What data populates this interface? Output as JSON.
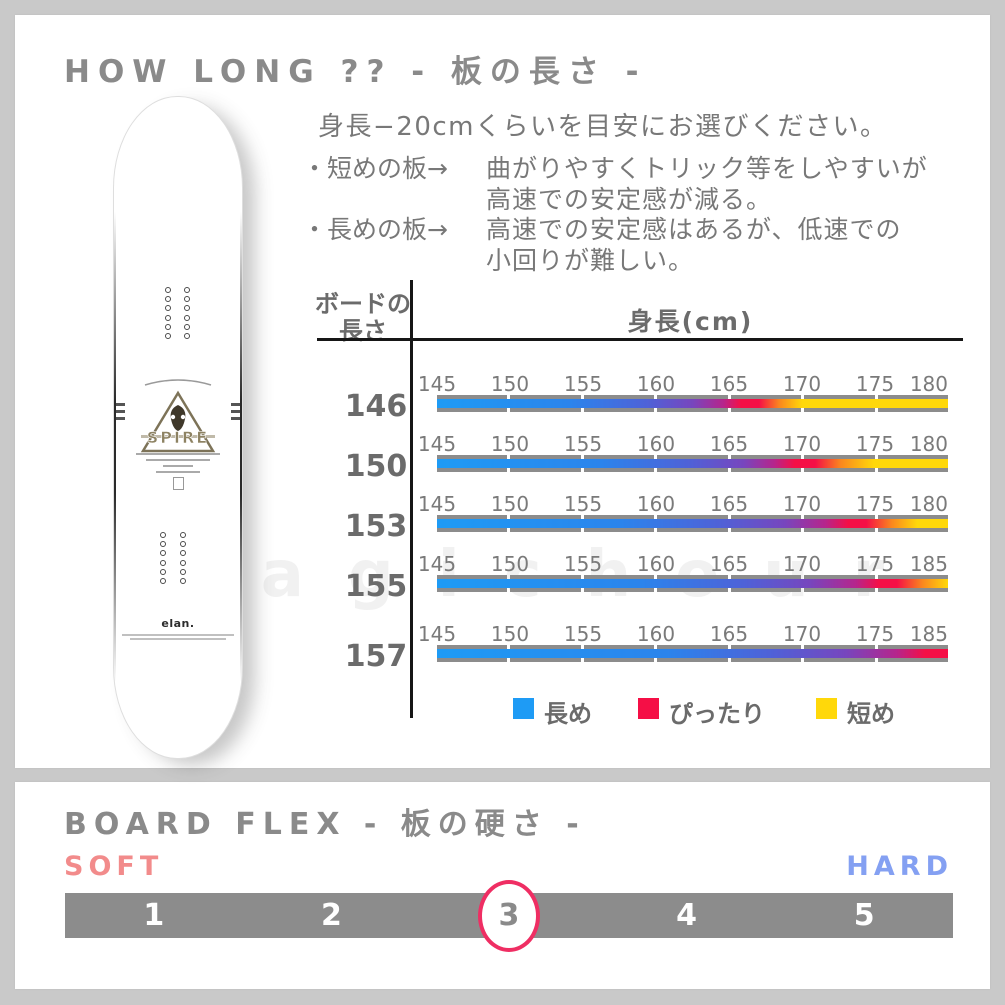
{
  "colors": {
    "page_bg": "#c9c9c9",
    "panel_bg": "#ffffff",
    "title_gray": "#8a8a8a",
    "text_gray": "#787878",
    "table_line": "#161616",
    "bar_gray": "#8c8c8c",
    "soft": "#F28B8B",
    "hard": "#84A0F2",
    "circle": "#EF2E63",
    "legend_blue": "#1E9BF5",
    "legend_red": "#F50F46",
    "legend_yellow": "#FFD80A"
  },
  "watermark": "magichour",
  "how_long": {
    "title": "HOW LONG ?? - 板の長さ -",
    "intro": "身長−20cmくらいを目安にお選びください。",
    "bullet1_label": "・短めの板→",
    "bullet1_line1": "曲がりやすくトリック等をしやすいが",
    "bullet1_line2": "高速での安定感が減る。",
    "bullet2_label": "・長めの板→",
    "bullet2_line1": "高速での安定感はあるが、低速での",
    "bullet2_line2": "小回りが難しい。"
  },
  "board": {
    "brand_logo": "SPIRE",
    "maker_logo": "elan."
  },
  "chart_data": [
    {
      "type": "heatmap",
      "title": "ボードの長さ × 身長(cm) フィットチャート",
      "row_header_line1": "ボードの",
      "row_header_line2": "長さ",
      "col_header": "身長(cm)",
      "legend": [
        {
          "label": "長め",
          "color": "#1E9BF5"
        },
        {
          "label": "ぴったり",
          "color": "#F50F46"
        },
        {
          "label": "短め",
          "color": "#FFD80A"
        }
      ],
      "rows": [
        {
          "length": "146",
          "ticks": [
            "145",
            "150",
            "155",
            "160",
            "165",
            "170",
            "175",
            "180"
          ],
          "best_fit_height": 166,
          "gradient": "linear-gradient(90deg,#1E9BF5 0%,#2B84EC 26%,#4E62D8 41%,#7746BE 50%,#B6258C 56%,#F50F46 59.5%,#F50F46 63%,#FA871E 67%,#FFD80A 71.5%,#FFD80A 100%)"
        },
        {
          "length": "150",
          "ticks": [
            "145",
            "150",
            "155",
            "160",
            "165",
            "170",
            "175",
            "180"
          ],
          "best_fit_height": 170,
          "gradient": "linear-gradient(90deg,#1E9BF5 0%,#2B84EC 32%,#4E62D8 49%,#7746BE 60%,#B6258C 66%,#F50F46 70%,#F50F46 74%,#FA871E 79%,#FFD80A 85.5%,#FFD80A 100%)"
        },
        {
          "length": "153",
          "ticks": [
            "145",
            "150",
            "155",
            "160",
            "165",
            "170",
            "175",
            "180"
          ],
          "best_fit_height": 173,
          "gradient": "linear-gradient(90deg,#1E9BF5 0%,#2B84EC 36%,#4E62D8 55%,#7746BE 68%,#B6258C 76%,#F50F46 80.5%,#F50F46 84%,#FA871E 89%,#FFD80A 94%,#FFD80A 100%)"
        },
        {
          "length": "155",
          "ticks": [
            "145",
            "150",
            "155",
            "160",
            "165",
            "170",
            "175",
            "185"
          ],
          "best_fit_height": 177,
          "gradient": "linear-gradient(90deg,#1E9BF5 0%,#2B84EC 40%,#4E62D8 60%,#7746BE 73%,#B6258C 82%,#F50F46 86.5%,#F50F46 90%,#FA871E 95%,#FFD80A 100%)"
        },
        {
          "length": "157",
          "ticks": [
            "145",
            "150",
            "155",
            "160",
            "165",
            "170",
            "175",
            "185"
          ],
          "best_fit_height": 183,
          "gradient": "linear-gradient(90deg,#1E9BF5 0%,#2B84EC 45%,#4E62D8 65%,#7746BE 80%,#B6258C 90%,#F50F46 95.5%,#F50F46 100%)"
        }
      ]
    },
    {
      "type": "scale",
      "title": "BOARD FLEX - 板の硬さ -",
      "min_label": "SOFT",
      "max_label": "HARD",
      "levels": [
        "1",
        "2",
        "3",
        "4",
        "5"
      ],
      "selected": "3"
    }
  ]
}
